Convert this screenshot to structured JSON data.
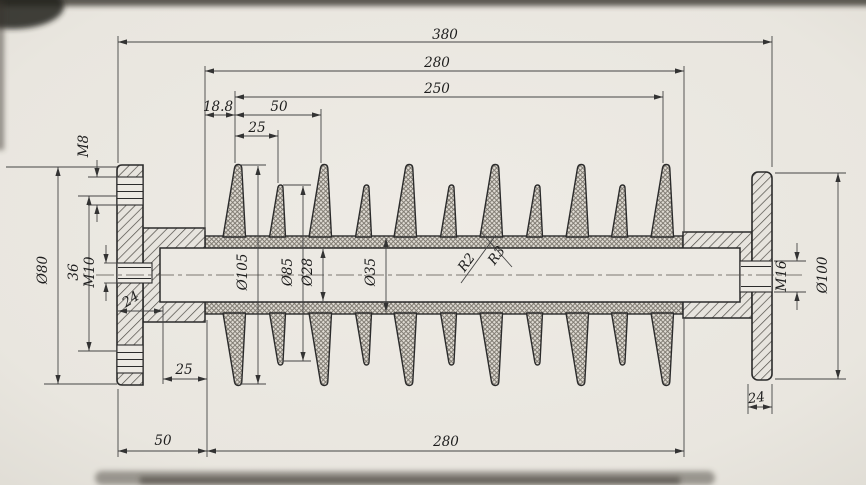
{
  "dimensions": {
    "top": {
      "overall_length": "380",
      "insulation_length": "280",
      "shed_span": "250",
      "first_shed_offset": "18.8",
      "large_shed_pitch": "50",
      "shed_spacing": "25"
    },
    "left_end": {
      "flange_hole_thread": "M8",
      "flange_diameter": "Ø80",
      "hole_spacing": "36",
      "stud_thread": "M10",
      "hub_length": "24"
    },
    "middle": {
      "large_shed_diameter": "Ø105",
      "small_shed_diameter": "Ø85",
      "core_rod_diameter": "Ø28",
      "sheath_diameter": "Ø35",
      "shed_root_radius_small": "R2",
      "shed_root_radius_large": "R3"
    },
    "right_end": {
      "stud_thread": "M16",
      "flange_diameter": "Ø100",
      "flange_thickness": "24"
    },
    "bottom": {
      "shed_offset": "25",
      "end_fitting_length": "50",
      "insulation_length": "280"
    }
  },
  "colors": {
    "paper": "#eae7e1",
    "outline": "#2b2b2b",
    "dimension_lines": "#454545",
    "metal_hatch": "#4f4c47",
    "rubber_hatch": "#7b766d"
  }
}
